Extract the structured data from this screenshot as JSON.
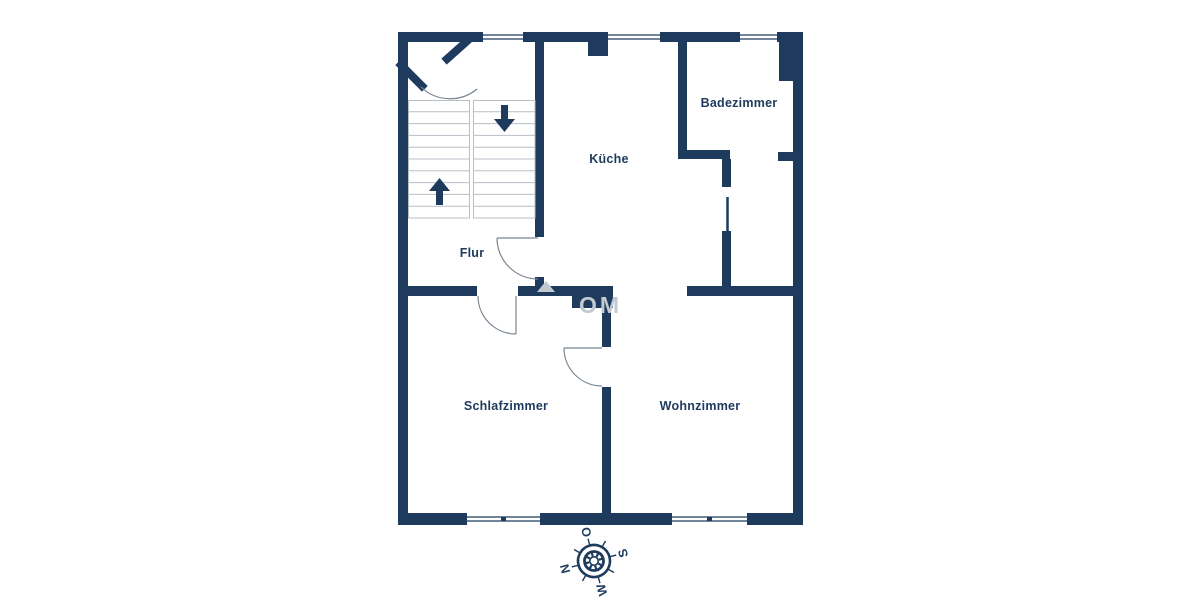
{
  "plan": {
    "rooms": [
      {
        "id": "kueche",
        "label": "Küche"
      },
      {
        "id": "badezimmer",
        "label": "Badezimmer"
      },
      {
        "id": "flur",
        "label": "Flur"
      },
      {
        "id": "schlafzimmer",
        "label": "Schlafzimmer"
      },
      {
        "id": "wohnzimmer",
        "label": "Wohnzimmer"
      }
    ],
    "stairs": {
      "flights": 2,
      "treads_per_flight": 10,
      "arrows": [
        "down",
        "up"
      ]
    },
    "windows": {
      "top_wall": 3,
      "bottom_wall": 2
    },
    "doors": {
      "swing_doors": 4,
      "straight_doors": 1
    }
  },
  "compass": {
    "labels": {
      "north": "N",
      "east": "O",
      "south": "S",
      "west": "W"
    },
    "rotation_deg": -105
  },
  "watermark": {
    "text": "OM"
  },
  "colors": {
    "wall": "#1e3a5d",
    "background": "#ffffff",
    "stair_lines": "#b8bfc7",
    "door_arc": "#7a8591",
    "label_text": "#1e3a5d",
    "watermark": "#c2c9d1"
  }
}
